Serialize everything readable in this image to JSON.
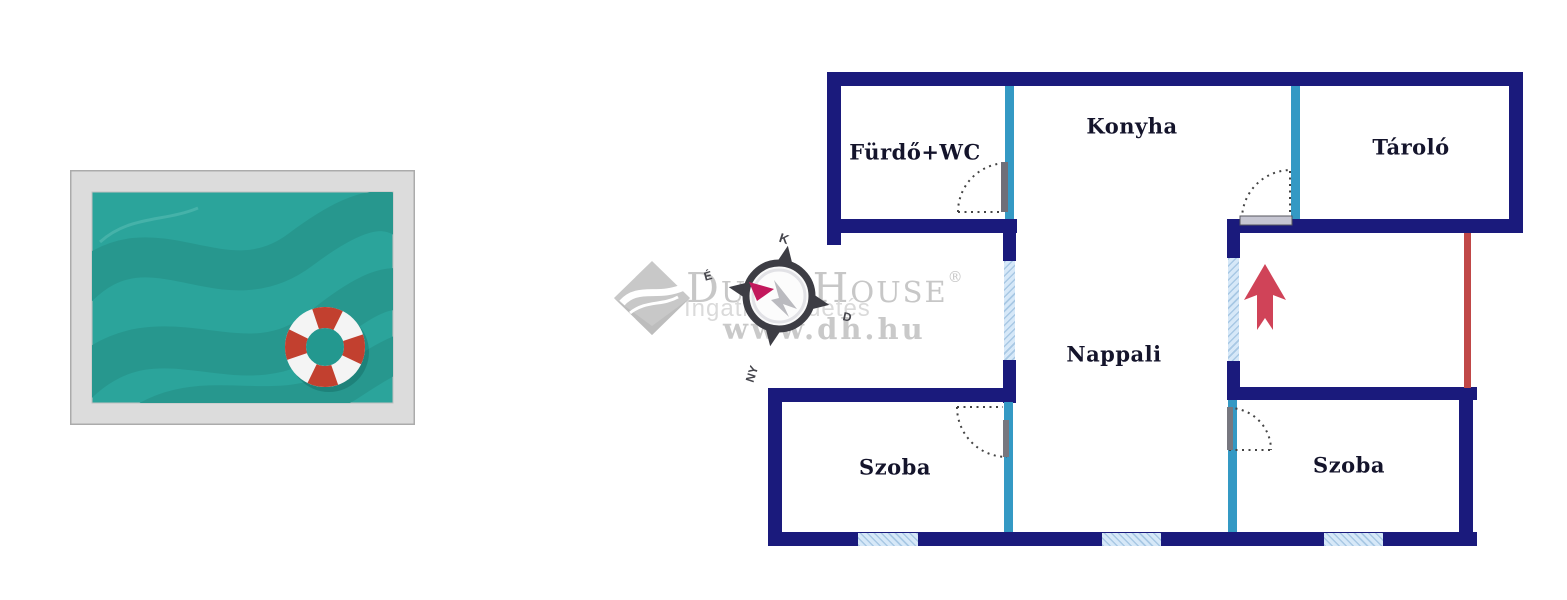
{
  "pool_image": {
    "description": "stylized top-view swimming pool illustration with red-and-white lifebuoy"
  },
  "floor_plan": {
    "rooms": [
      {
        "label": "Fürdő+WC"
      },
      {
        "label": "Konyha"
      },
      {
        "label": "Tároló"
      },
      {
        "label": "Nappali"
      },
      {
        "label": "Szoba"
      },
      {
        "label": "Szoba"
      }
    ],
    "compass": {
      "top": "K",
      "bottom": "NY",
      "left": "É",
      "right": "D"
    },
    "colors": {
      "wall": "#1a1a7c",
      "partition": "#3499c4",
      "window_fill": "#d6e8f8",
      "window_hatch": "#a8c8e4",
      "terrace_line": "#c04848",
      "entrance_arrow": "#d04358",
      "door_arc": "#444444",
      "pool_water": "#2ba49b",
      "pool_wave": "#27978e",
      "pool_deck": "#dcdcdc",
      "buoy_red": "#c2402f",
      "buoy_white": "#f4f4f4"
    }
  },
  "watermark": {
    "brand": "Duna House",
    "registered": "®",
    "tagline": "Ingatlanhirdetés",
    "url": "www.dh.hu"
  }
}
